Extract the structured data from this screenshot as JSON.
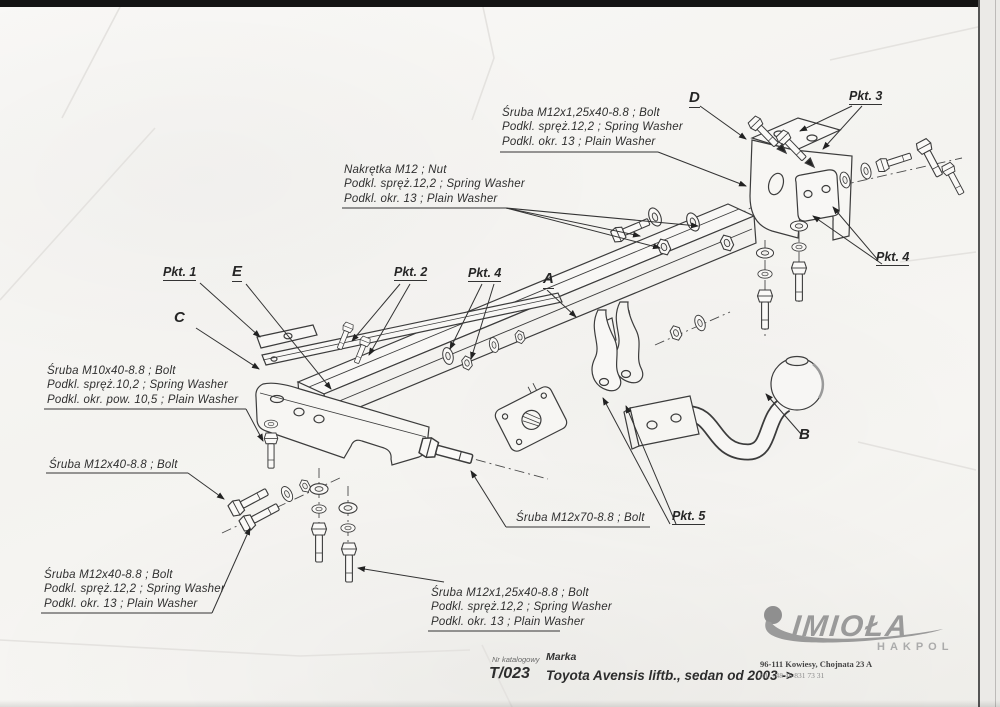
{
  "annotations": {
    "points": {
      "pkt1": "Pkt. 1",
      "pkt2": "Pkt. 2",
      "pkt3": "Pkt. 3",
      "pkt4_left": "Pkt. 4",
      "pkt4_right": "Pkt. 4",
      "pkt5": "Pkt. 5"
    },
    "letters": {
      "a": "A",
      "b": "B",
      "c": "C",
      "d": "D",
      "e": "E"
    },
    "specs": {
      "top_bolt": [
        "Śruba M12x1,25x40-8.8 ;  Bolt",
        "Podkl. spręż.12,2 ; Spring Washer",
        "Podkl. okr. 13 ; Plain Washer"
      ],
      "nut": [
        "Nakrętka  M12 ; Nut",
        "Podkl. spręż.12,2 ; Spring Washer",
        "Podkl. okr. 13 ; Plain Washer"
      ],
      "left_m10": [
        "Śruba M10x40-8.8 ;  Bolt",
        "Podkl. spręż.10,2 ; Spring Washer",
        "Podkl. okr. pow. 10,5 ; Plain Washer"
      ],
      "left_m12": [
        "Śruba M12x40-8.8 ;  Bolt"
      ],
      "bottom_left": [
        "Śruba M12x40-8.8 ;  Bolt",
        "Podkl. spręż.12,2 ; Spring Washer",
        "Podkl. okr. 13 ; Plain Washer"
      ],
      "bottom_mid": [
        "Śruba M12x1,25x40-8.8 ;  Bolt",
        "Podkl. spręż.12,2 ; Spring Washer",
        "Podkl. okr. 13 ; Plain Washer"
      ],
      "m12x70": [
        "Śruba M12x70-8.8 ;  Bolt"
      ]
    }
  },
  "footer": {
    "catalog_label": "Nr katalogowy",
    "brand_label": "Marka",
    "catalog_number": "T/023",
    "vehicle": "Toyota Avensis liftb., sedan  od 2003 ->",
    "address": "96-111 Kowiesy, Chojnata 23 A",
    "phone": "tel. +48 46 831 73 31"
  },
  "logo": {
    "name": "IMIOŁA",
    "sub": "HAKPOL"
  },
  "colors": {
    "ink": "#2f2f2f",
    "paper": "#f6f5f2",
    "logo_gray": "#9a9a9a"
  }
}
